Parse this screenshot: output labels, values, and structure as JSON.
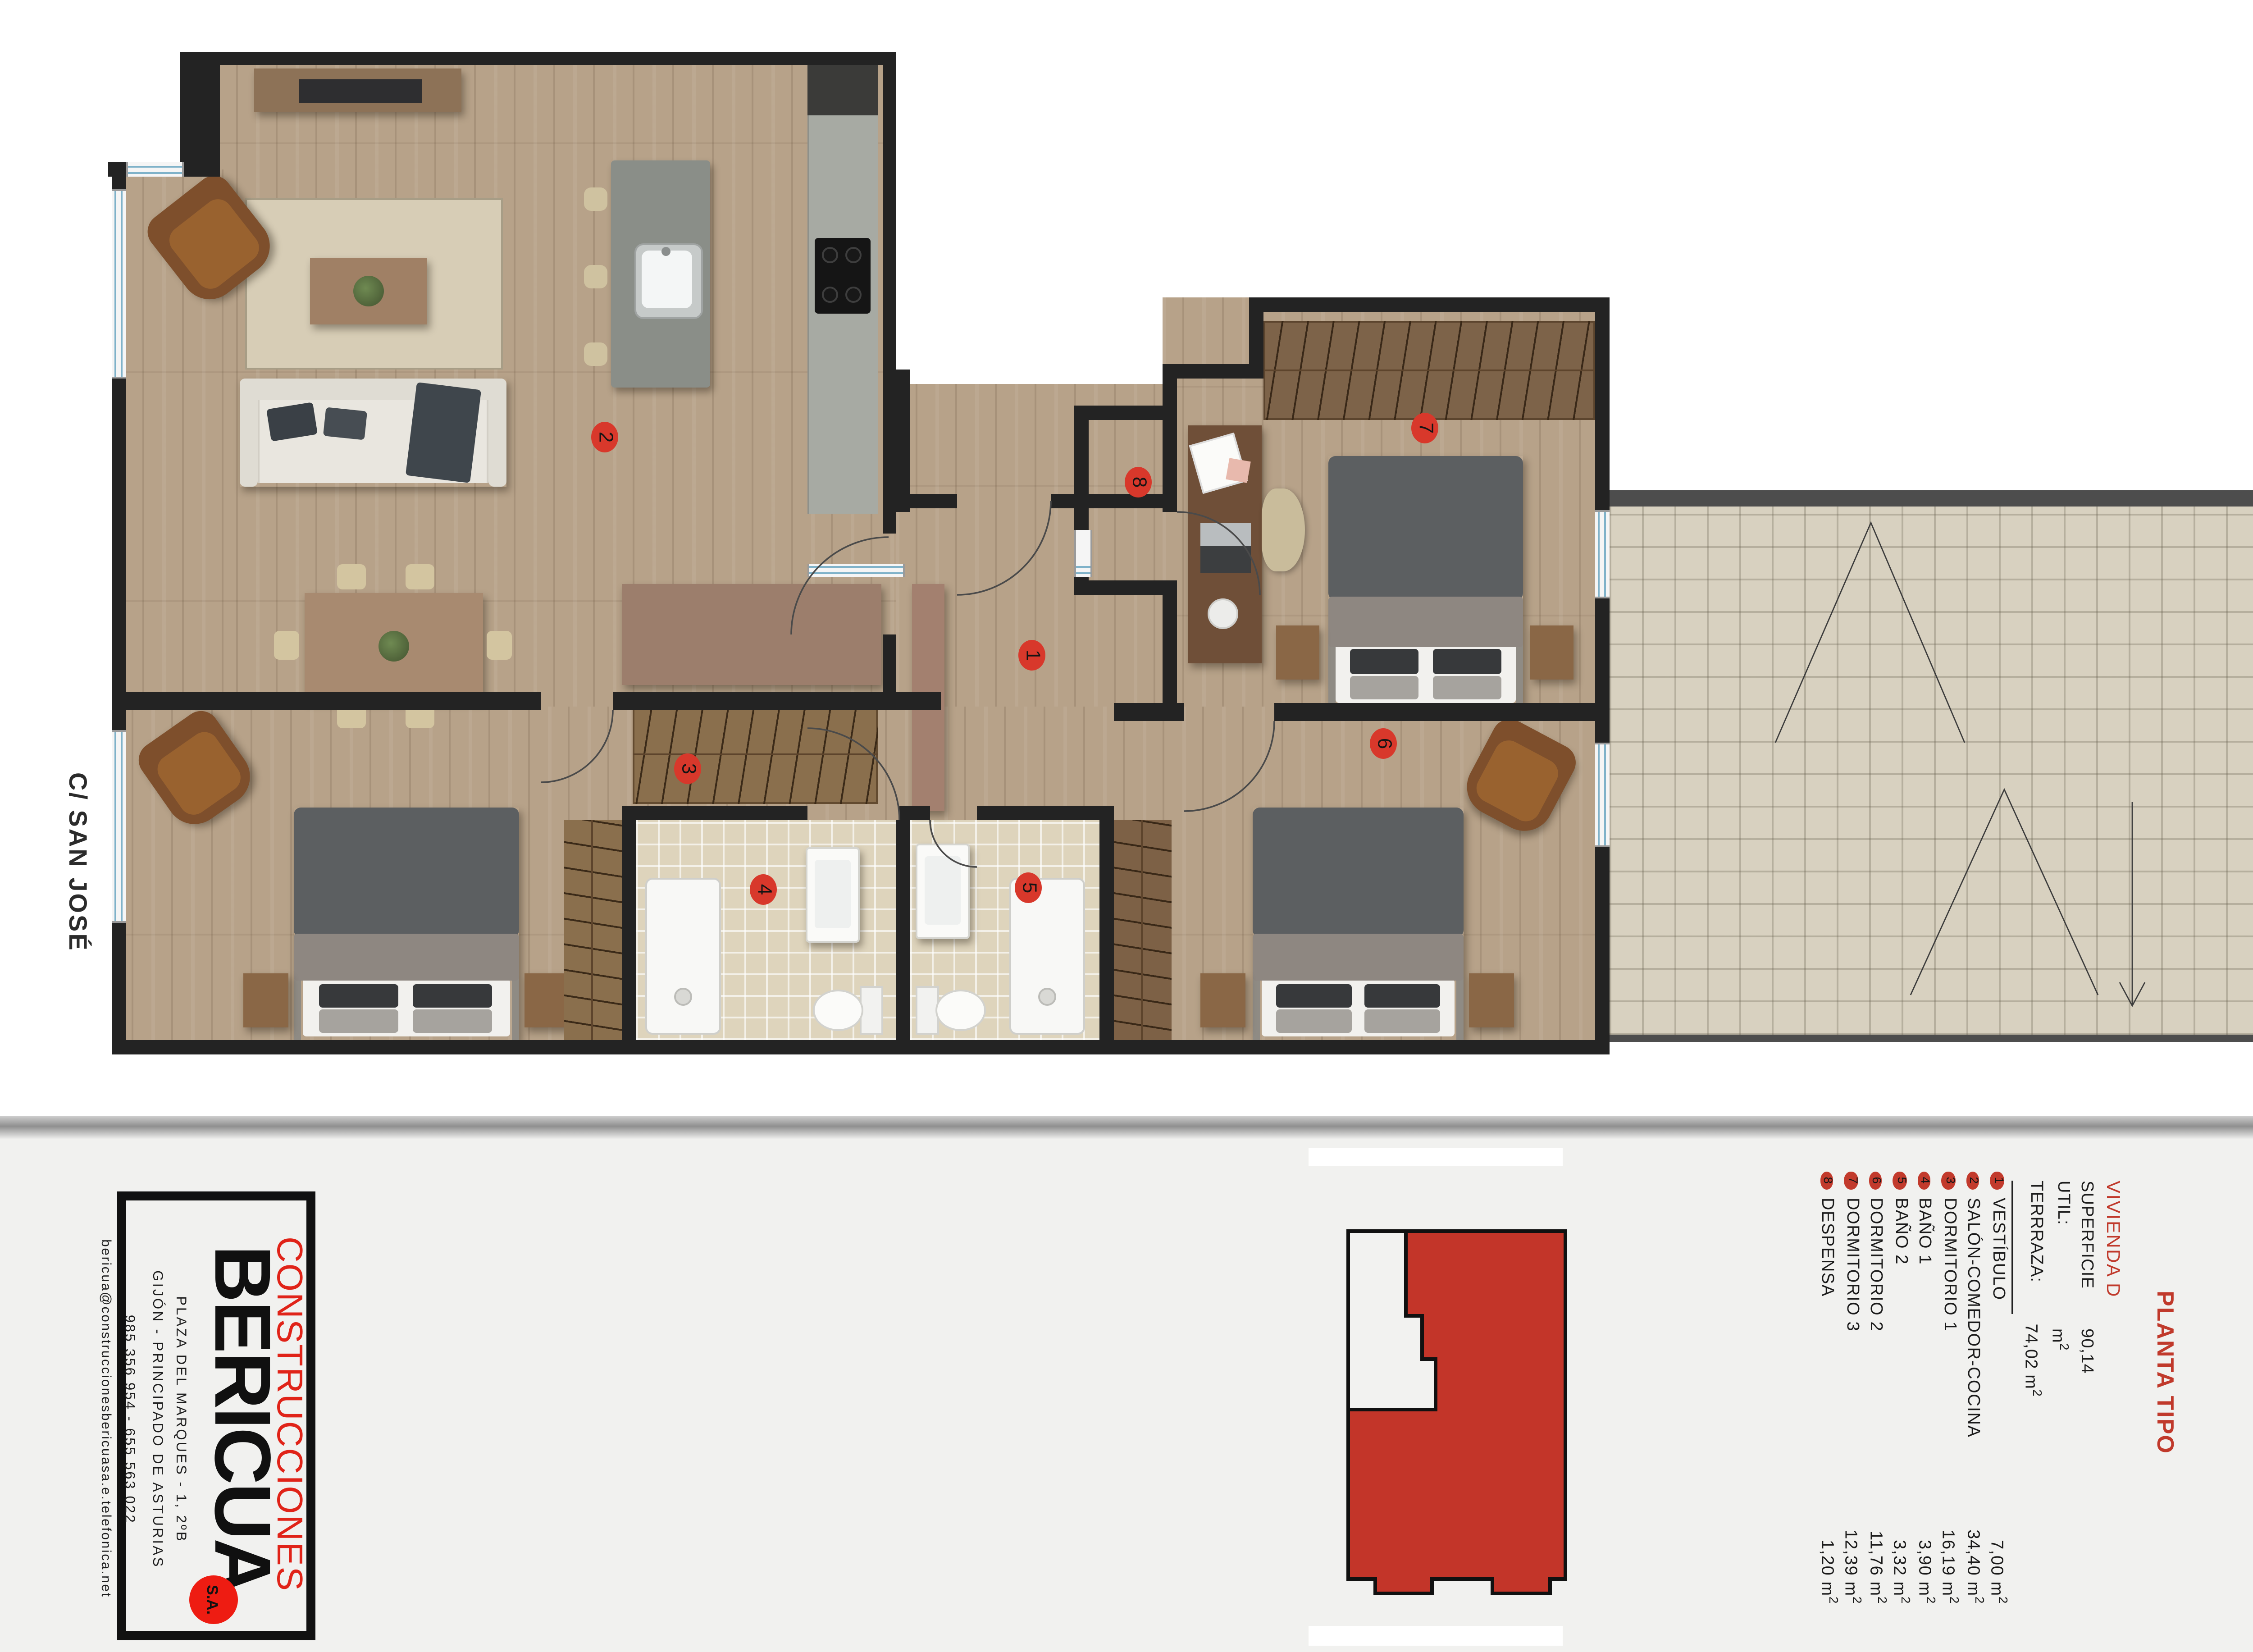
{
  "sheet": {
    "street_label": "C/ SAN JOSÉ",
    "plan_title": "PLANTA TIPO",
    "unit_title": "VIVIENDA D"
  },
  "company": {
    "name_top": "CONSTRUCCIONES",
    "name_main": "BERICUA",
    "legal": "S.A.",
    "address": "PLAZA DEL MARQUES - 1, 2ºB",
    "city": "GIJÓN - PRINCIPADO DE ASTURIAS",
    "phones": "985 356 954 - 655 563 022",
    "email": "bericua@construccionesbericuasa.e.telefonica.net"
  },
  "legend": {
    "superficie_label": "SUPERFICIE UTIL:",
    "superficie_value": "90,14 m",
    "terraza_label": "TERRRAZA:",
    "terraza_value": "74,02 m",
    "rooms": [
      {
        "num": "1",
        "name": "VESTÍBULO",
        "area": "7,00 m"
      },
      {
        "num": "2",
        "name": "SALÓN-COMEDOR-COCINA",
        "area": "34,40 m"
      },
      {
        "num": "3",
        "name": "DORMITORIO 1",
        "area": "16,19 m"
      },
      {
        "num": "4",
        "name": "BAÑO 1",
        "area": "3,90 m"
      },
      {
        "num": "5",
        "name": "BAÑO 2",
        "area": "3,32 m"
      },
      {
        "num": "6",
        "name": "DORMITORIO 2",
        "area": "11,76 m"
      },
      {
        "num": "7",
        "name": "DORMITORIO 3",
        "area": "12,39 m"
      },
      {
        "num": "8",
        "name": "DESPENSA",
        "area": "1,20 m"
      }
    ]
  },
  "colors": {
    "marker_red": "#d8382b",
    "legend_dot_red": "#c23a2c",
    "brand_red": "#e8251b",
    "title_red": "#c0392b",
    "wall": "#232323",
    "wood_floor": "#b7a289",
    "terrace_tile": "#d8d1c0",
    "bath_tile": "#ded4bc"
  }
}
